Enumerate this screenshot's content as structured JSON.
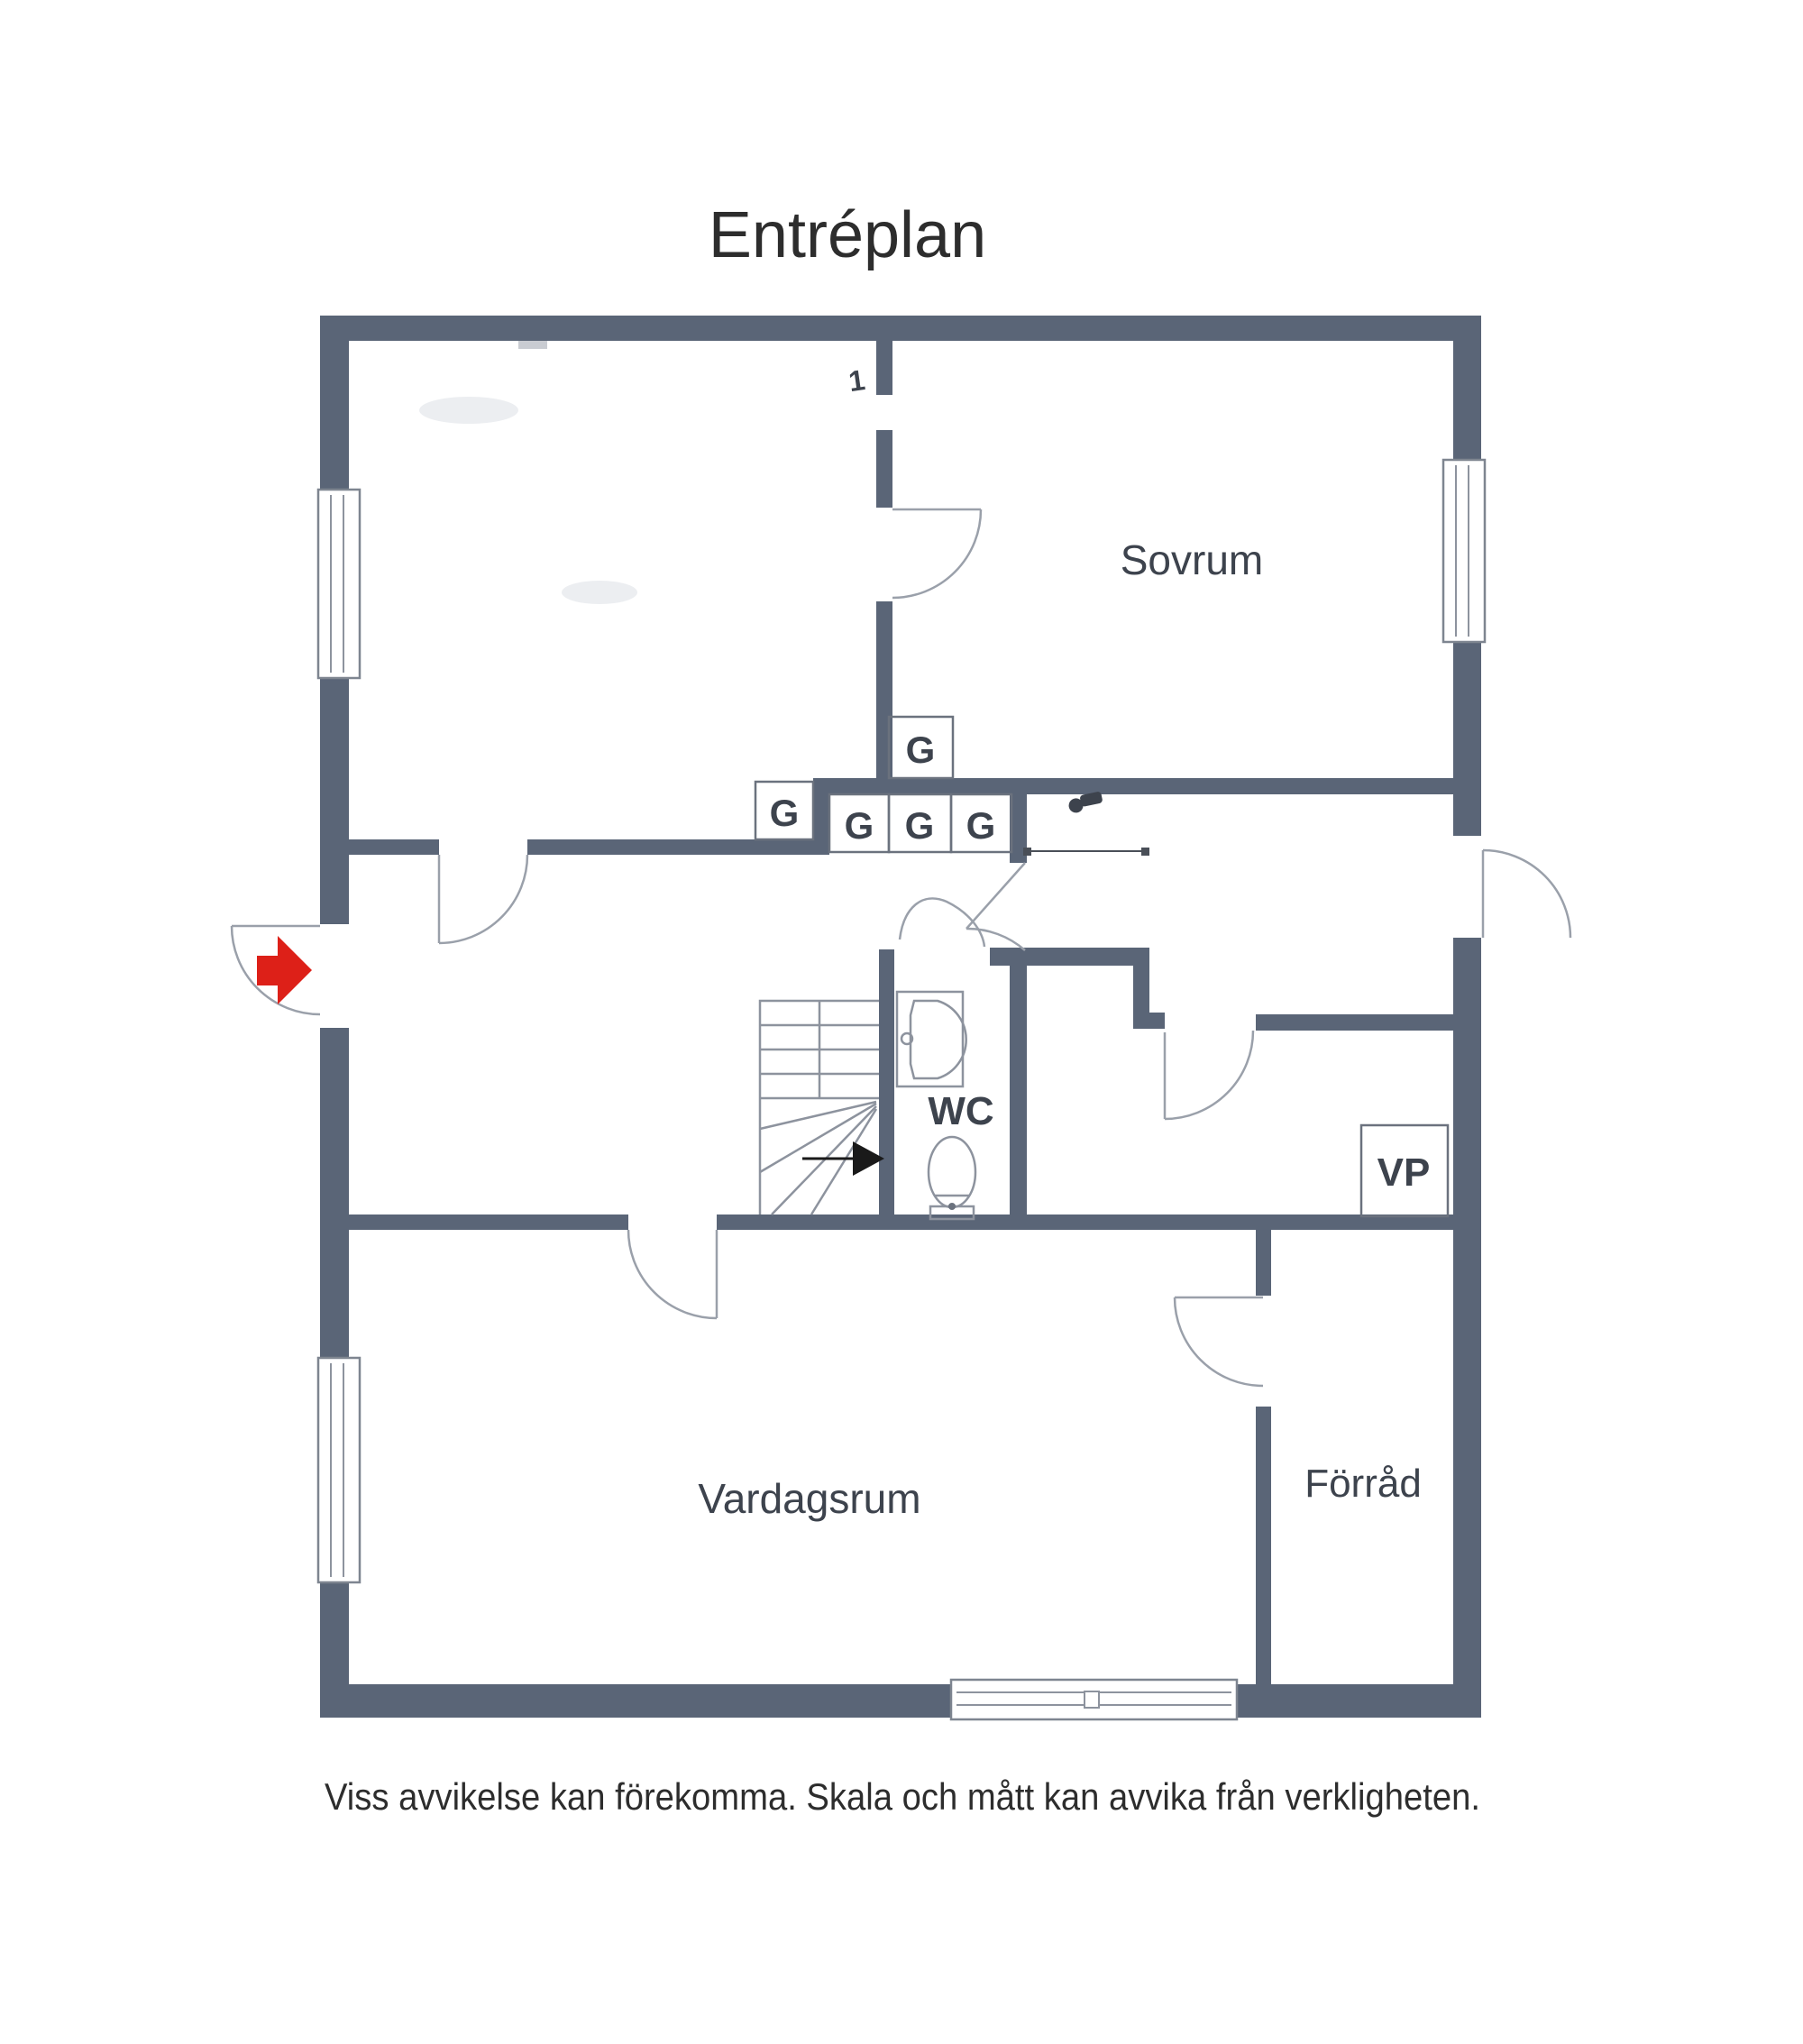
{
  "page": {
    "title": "Entréplan",
    "disclaimer": "Viss avvikelse kan förekomma. Skala och mått kan avvika från verkligheten."
  },
  "floor_plan": {
    "room_labels": {
      "sovrum": "Sovrum",
      "wc": "WC",
      "vardagsrum": "Vardagsrum",
      "forrad": "Förråd"
    },
    "markers": {
      "closet": "G",
      "heat_pump": "VP",
      "stair_number": "1"
    },
    "colors": {
      "wall": "#5a6577",
      "thin_line": "#8d939e",
      "door_arc": "#9aa0aa",
      "entrance_arrow": "#dd2018",
      "label_text": "#3d434d"
    }
  }
}
